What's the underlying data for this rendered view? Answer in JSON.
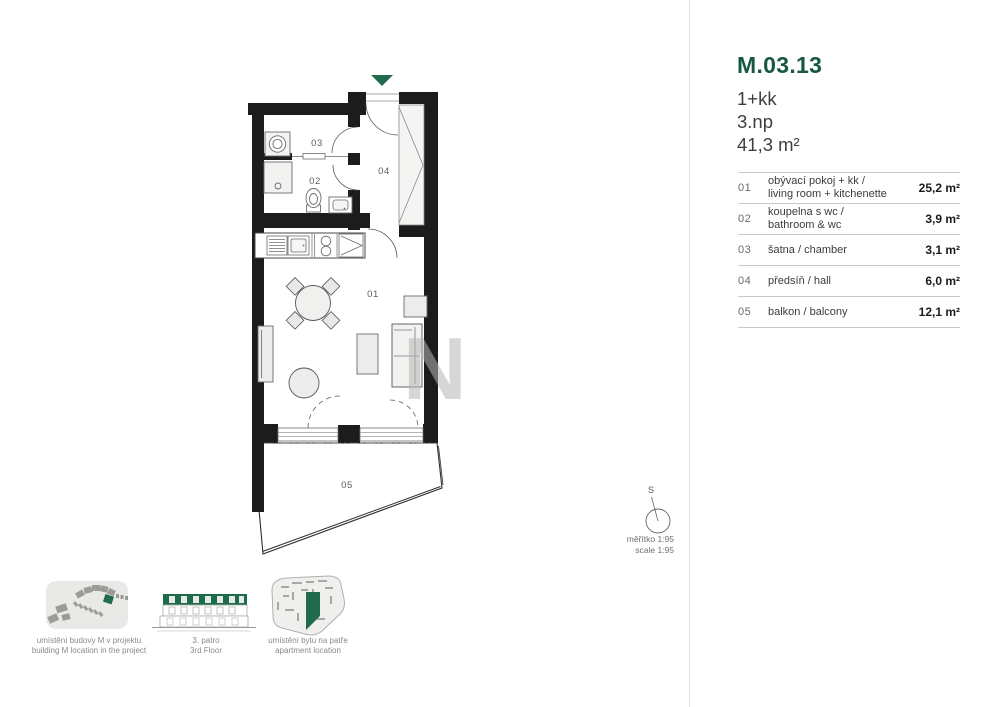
{
  "unit": {
    "code": "M.03.13",
    "layout": "1+kk",
    "floor": "3.np",
    "total_area": "41,3 m²"
  },
  "rooms": [
    {
      "number": "01",
      "name_lines": [
        "obývací pokoj + kk /",
        "living room + kitchenette"
      ],
      "area": "25,2 m²"
    },
    {
      "number": "02",
      "name_lines": [
        "koupelna s wc /",
        "bathroom & wc"
      ],
      "area": "3,9 m²"
    },
    {
      "number": "03",
      "name_lines": [
        "šatna / chamber"
      ],
      "area": "3,1 m²"
    },
    {
      "number": "04",
      "name_lines": [
        "předsíň / hall"
      ],
      "area": "6,0 m²"
    },
    {
      "number": "05",
      "name_lines": [
        "balkon / balcony"
      ],
      "area": "12,1 m²"
    }
  ],
  "plan_labels": {
    "r01": "01",
    "r02": "02",
    "r03": "03",
    "r04": "04",
    "r05": "05"
  },
  "watermark": "N",
  "compass": {
    "north_label": "S"
  },
  "scale": {
    "line1": "měřítko 1:95",
    "line2": "scale 1:95"
  },
  "thumbnails": {
    "site": {
      "line1": "umístění budovy M v projektu",
      "line2": "building M location in the project"
    },
    "floor": {
      "line1": "3. patro",
      "line2": "3rd Floor"
    },
    "unit": {
      "line1": "umístění bytu na patře",
      "line2": "apartment location"
    }
  },
  "colors": {
    "brand_green": "#16593f",
    "accent_green": "#1f6b4c",
    "wall_black": "#1c1c1c"
  }
}
